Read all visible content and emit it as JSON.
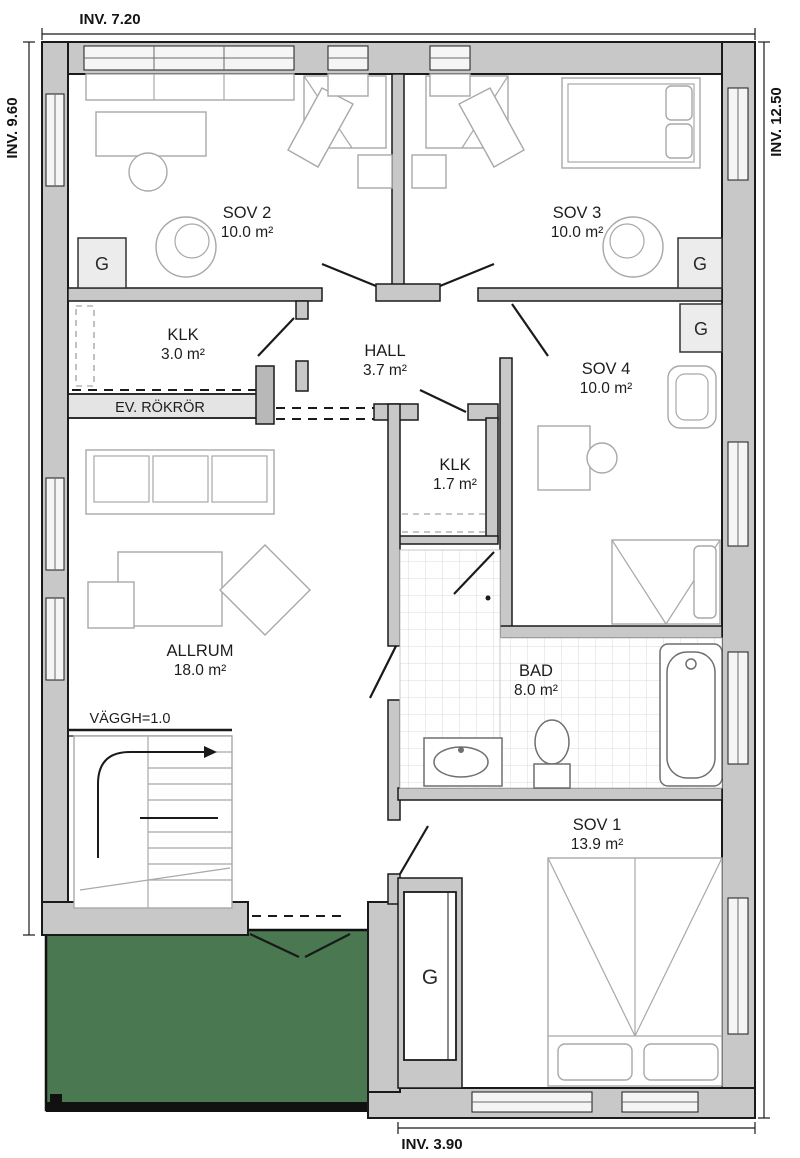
{
  "dimensions": {
    "top": "INV. 7.20",
    "left": "INV. 9.60",
    "right": "INV. 12.50",
    "bottom": "INV. 3.90"
  },
  "rooms": [
    {
      "name": "SOV 2",
      "area": "10.0 m²"
    },
    {
      "name": "SOV 3",
      "area": "10.0 m²"
    },
    {
      "name": "KLK",
      "area": "3.0 m²"
    },
    {
      "name": "HALL",
      "area": "3.7 m²"
    },
    {
      "name": "SOV 4",
      "area": "10.0 m²"
    },
    {
      "name": "KLK",
      "area": "1.7 m²"
    },
    {
      "name": "ALLRUM",
      "area": "18.0 m²"
    },
    {
      "name": "BAD",
      "area": "8.0 m²"
    },
    {
      "name": "SOV 1",
      "area": "13.9 m²"
    }
  ],
  "annotations": {
    "flue": "EV. RÖKRÖR",
    "wall_height": "VÄGGH=1.0",
    "wardrobe": "G"
  },
  "colors": {
    "wall_fill": "#c8c8c8",
    "wall_stroke": "#1a1a1a",
    "terrace_green": "#4a7850",
    "furniture_line": "#a8a8a8",
    "text": "#1d1d1d"
  }
}
